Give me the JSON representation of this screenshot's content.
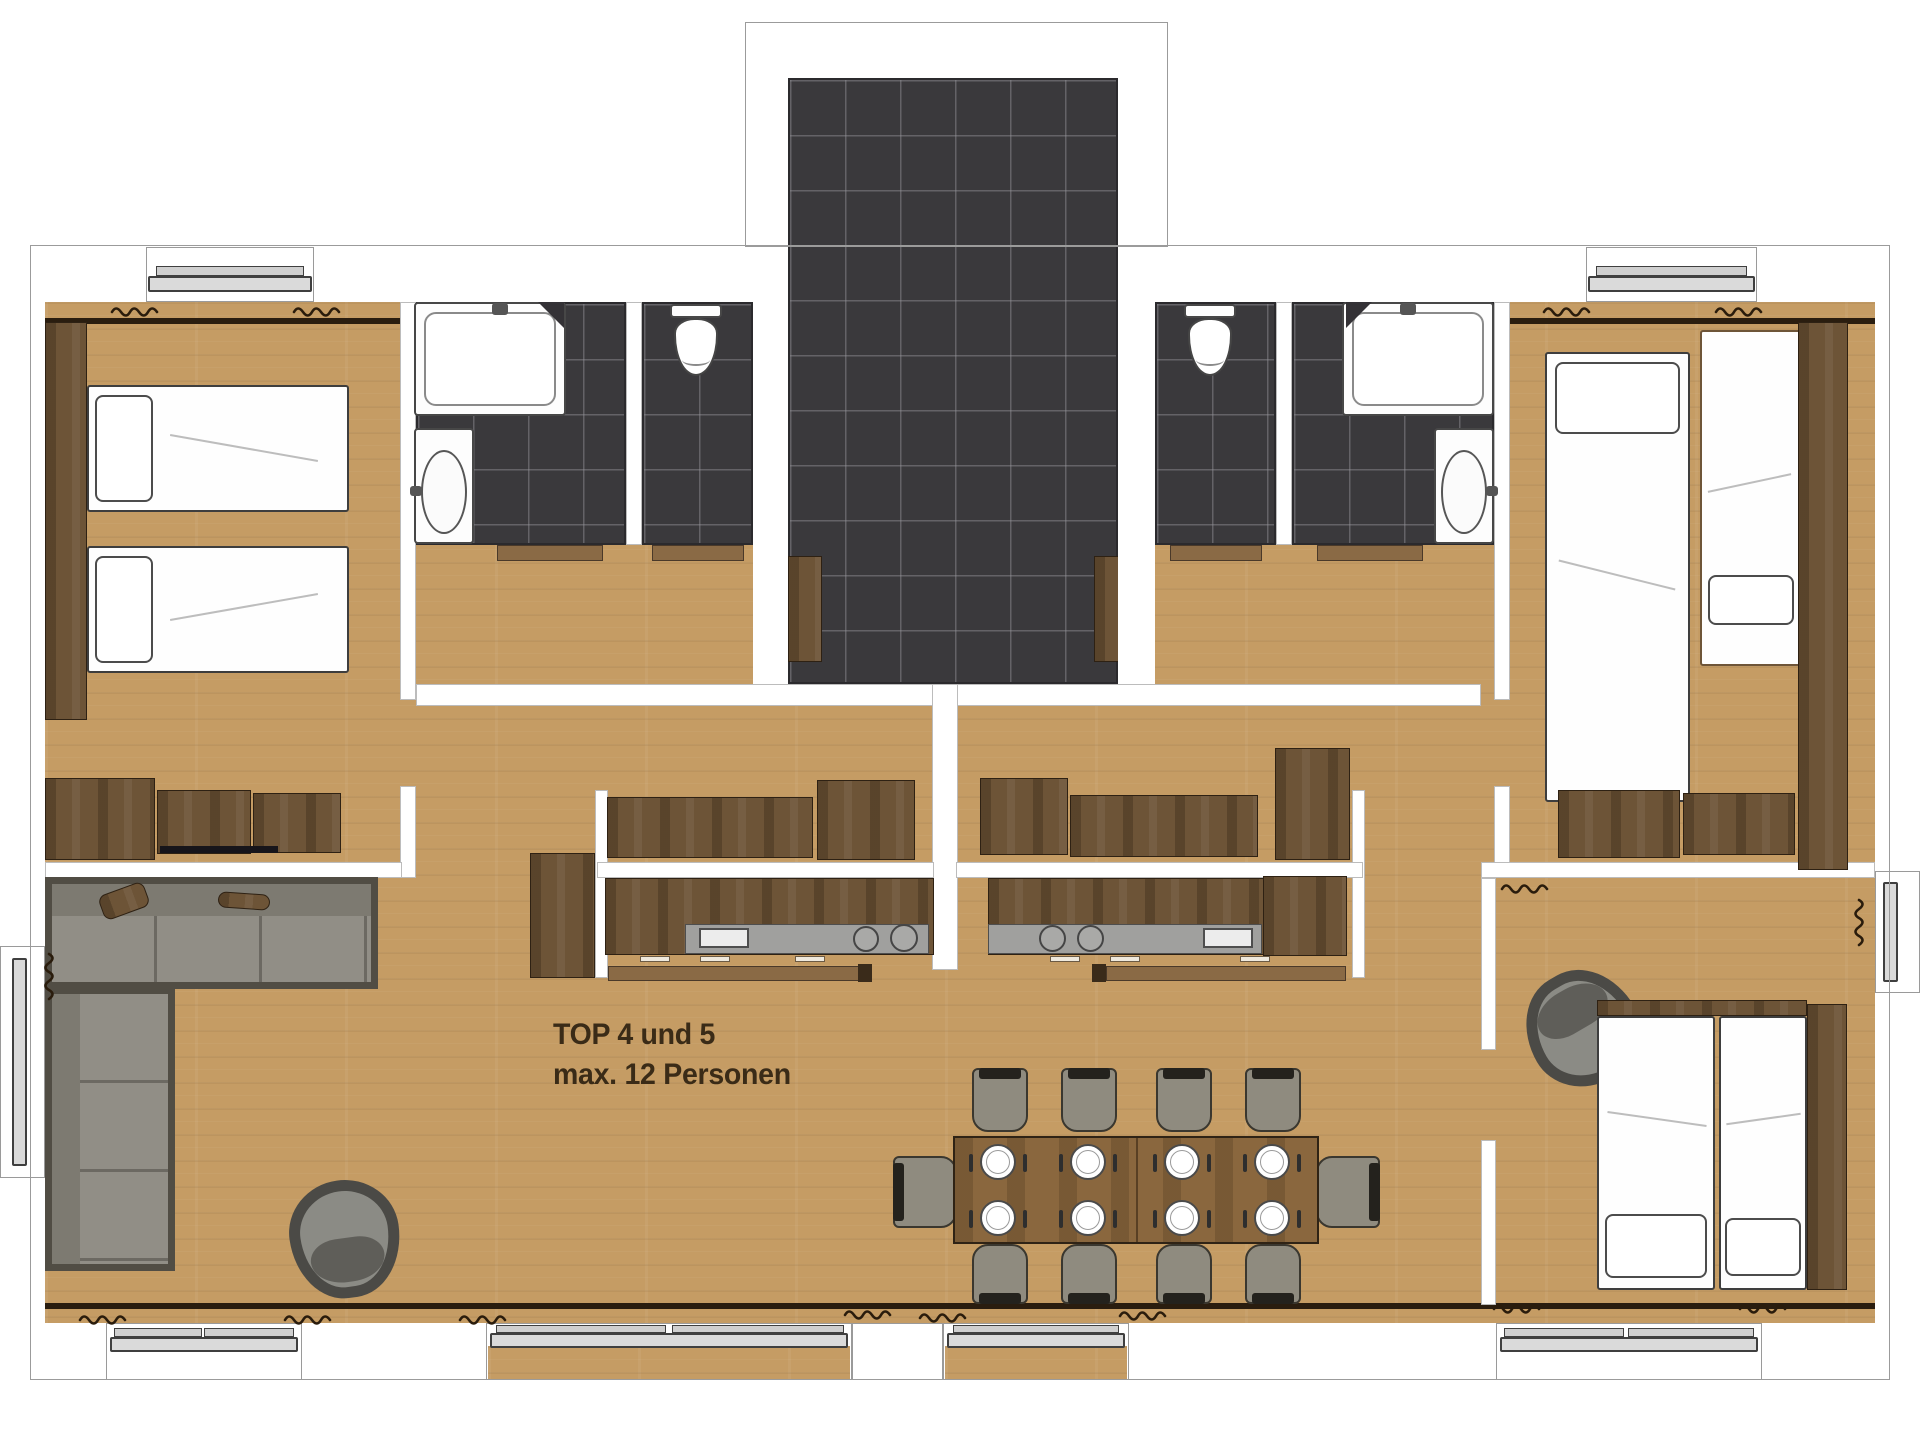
{
  "annotation": {
    "line1": "TOP 4 und 5",
    "line2": "max. 12 Personen"
  },
  "palette": {
    "background": "#ffffff",
    "floor_wood": "#c59c64",
    "furniture_wood": "#6d5437",
    "tile_dark": "#3a393c",
    "wall_white": "#ffffff",
    "wall_line": "#2a1d0f",
    "counter_gray": "#a0a09e",
    "sofa_gray": "#918e86",
    "table_wood": "#8a673e",
    "text": "#3a2b17"
  },
  "inventory": {
    "unit_label": "TOP 4 und 5",
    "max_persons": 12,
    "beds": 6,
    "dining_chairs": 10,
    "place_settings": 8,
    "l_shaped_sofas": 1,
    "armchairs": 2,
    "bathtubs": 2,
    "toilets": 2,
    "washbasins": 2,
    "kitchen_counters": 2,
    "tiled_entrance_halls": 1
  }
}
